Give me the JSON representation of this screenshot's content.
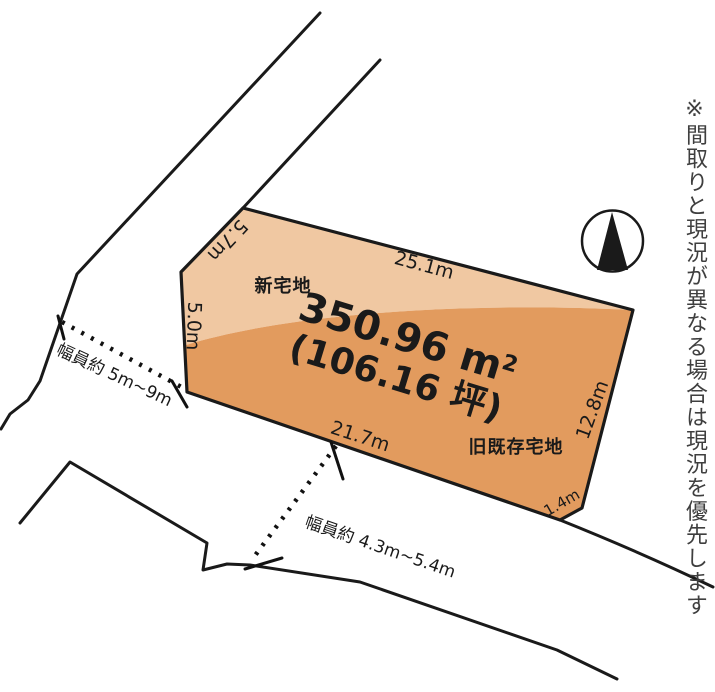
{
  "diagram": {
    "plot": {
      "area_value": "350.96 m",
      "area_sup": "2",
      "area_tsubo": "(106.16 坪)",
      "label_new": "新宅地",
      "label_old": "旧既存宅地",
      "fill_new": "#F0C8A2",
      "fill_old": "#E29B5E",
      "outline_color": "#1a1a1a"
    },
    "dimensions": {
      "top": "25.1m",
      "upper_left": "5.7m",
      "left": "5.0m",
      "right": "12.8m",
      "bottom": "21.7m",
      "corner": "1.4m"
    },
    "roads": {
      "left_width_label": "幅員約 5m~9m",
      "bottom_width_label": "幅員約 4.3m~5.4m"
    },
    "note_vertical": "※間取りと現況が異なる場合は現況を優先します",
    "colors": {
      "line": "#1a1a1a",
      "note_text": "#3f3f3f"
    }
  }
}
